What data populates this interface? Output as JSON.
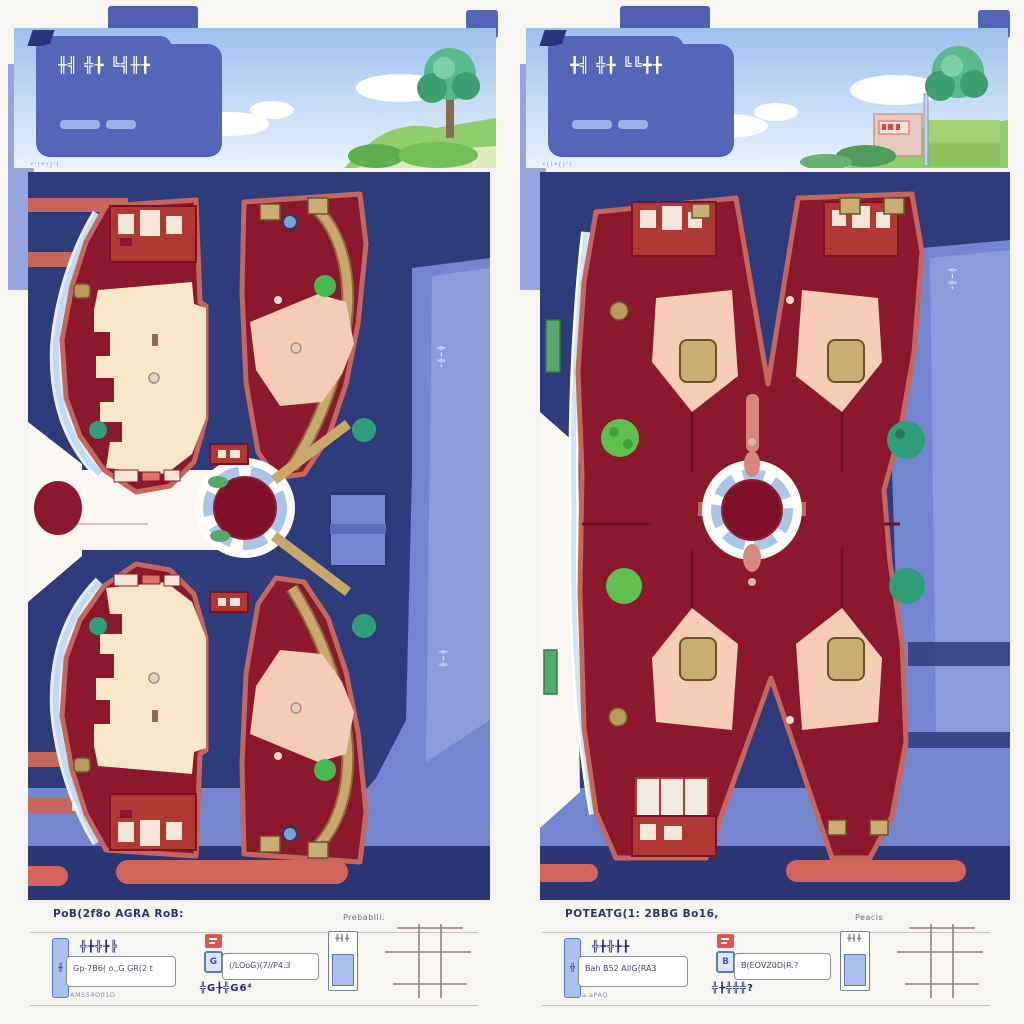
{
  "palette": {
    "navy": "#2e3c7c",
    "navy_dark": "#2b3774",
    "periwinkle": "#7386cf",
    "periwinkle_light": "#8fa0dc",
    "maroon": "#8c182e",
    "crimson_center": "#7e1127",
    "salmon_border": "#c4685f",
    "salmon_bar": "#d4655c",
    "brick": "#b03a33",
    "cream": "#f7e7c9",
    "pink_room": "#f5cdb4",
    "tan_path": "#c9a76a",
    "gold_square": "#c9ad72",
    "tree_green": "#49b84f",
    "tree_teal": "#2e9e78",
    "water_edge": "#bfdcf2",
    "card_blue": "#5565b8",
    "sky_top": "#9cc0ee",
    "sky_bottom": "#e9f3fd",
    "hill_green": "#8fce6b",
    "legend_text": "#2b3473"
  },
  "panels": [
    {
      "name": "left-map-variant",
      "banner": {
        "card_title": "╫╣ ╬╊ ╚╣╫╊",
        "corner_note": "*'!*!)'!"
      },
      "map": {
        "road_label_1": "╬╍╬╸",
        "road_label_2": "╬╍╬"
      },
      "legend": {
        "heading": "PoB(2f8o AGRA RoB:",
        "heading_right": "Prebablli.",
        "group1": {
          "pill_glyph": "╫",
          "title": "╬╊╬╊╠",
          "field_text": "Gp-7B6( o.,G GR(2 t",
          "subtext": "AM554O01D"
        },
        "group2": {
          "icon_glyph": "G",
          "field_text": "(/LOoG)(7//P4.3",
          "caption": "╬G╊╬G6⁴"
        },
        "group3": {
          "label": "╬╣╬"
        }
      }
    },
    {
      "name": "right-map-variant",
      "banner": {
        "card_title": "╋╣ ╬╊ ╚╚╋╊",
        "corner_note": "*(!*()'!"
      },
      "map": {
        "road_label_1": "╬╍╬╸"
      },
      "legend": {
        "heading": "POTEATG(1: 2BBG Bo16,",
        "heading_right": "Peacls",
        "group1": {
          "pill_glyph": "╬",
          "title": "╬╊╬╊╊",
          "field_text": "Bah B52 AIIG(RA3",
          "subtext": "a.aPAQ"
        },
        "group2": {
          "icon_glyph": "B",
          "field_text": "B(EOVZ0D(R.?",
          "caption": "╬╊╬╬╬?"
        },
        "group3": {
          "label": "╬╣╬"
        }
      }
    }
  ]
}
